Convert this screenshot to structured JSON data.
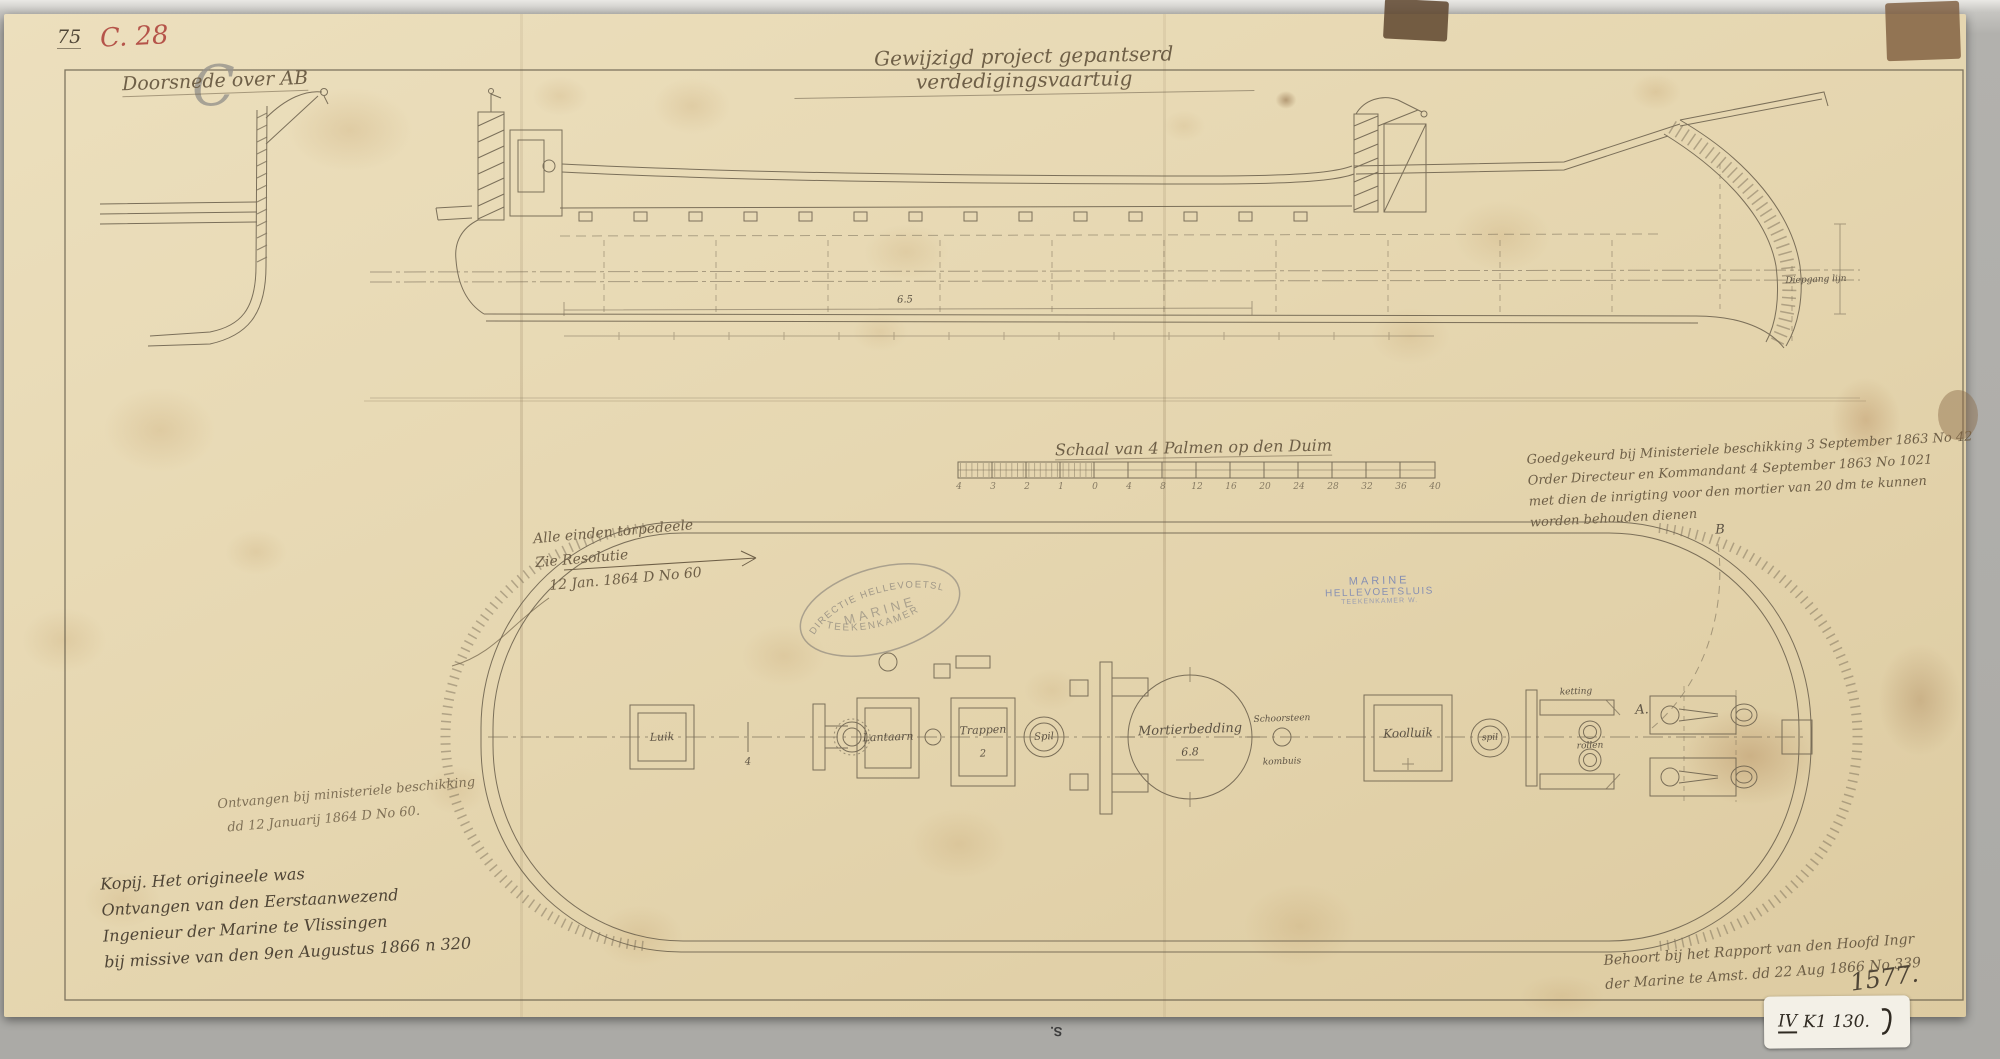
{
  "sheet": {
    "corner_number": "75",
    "corner_letter": "C",
    "corner_code": "C. 28",
    "title": "Gewijzigd project gepantserd verdedigingsvaartuig",
    "section_label": "Doorsnede over AB",
    "edge_mark": "S.",
    "archive_number": "1577.",
    "archive_label_roman": "IV",
    "archive_label_rest": "K1 130."
  },
  "scalebar": {
    "label": "Schaal van 4 Palmen op den Duim",
    "ticks": [
      "4",
      "3",
      "2",
      "1",
      "0",
      "4",
      "8",
      "12",
      "16",
      "20",
      "24",
      "28",
      "32",
      "36",
      "40"
    ]
  },
  "notes": {
    "resolution": [
      "Alle einden torpedeele",
      "Zie Resolutie",
      "12 Jan. 1864 D No 60"
    ],
    "approval": [
      "Goedgekeurd bij Ministeriele beschikking 3 September 1863 No 42",
      "Order Directeur en Kommandant 4 September 1863 No 1021",
      "met dien de inrigting voor den mortier van 20 dm te kunnen",
      "worden behouden dienen"
    ],
    "received": [
      "Ontvangen bij ministeriele beschikking",
      "dd 12 Januarij 1864 D No 60."
    ],
    "copy": [
      "Kopij. Het origineele was",
      "Ontvangen van den Eerstaanwezend",
      "Ingenieur der Marine te Vlissingen",
      "bij missive van den 9en Augustus 1866 n 320"
    ],
    "report": [
      "Behoort bij het Rapport van den Hoofd Ingr",
      "der Marine te Amst. dd 22 Aug 1866 No 339"
    ]
  },
  "stamps": {
    "oval_top": "DIRECTIE HELLEVOETSLUIS",
    "oval_middle": "MARINE",
    "oval_bottom": "TEEKENKAMER",
    "blue_line1": "MARINE",
    "blue_line2": "HELLEVOETSLUIS",
    "blue_line3": "TEEKENKAMER W."
  },
  "plan": {
    "luik": "Luik",
    "tick4": "4",
    "lantaarn": "Lantaarn",
    "trappen": "Trappen",
    "trappen_n": "2",
    "spil1": "Spil",
    "mortier": "Mortierbedding",
    "mortier_dim": "6.8",
    "schoorsteen": "Schoorsteen",
    "kombuis": "kombuis",
    "koolluik": "Koolluik",
    "spil2": "spil",
    "ketting": "ketting",
    "rollen": "rollen",
    "marker_a": "A.",
    "marker_b": "B"
  },
  "elevation": {
    "dim_length": "6.5",
    "waterline_note": "Diepgang lijn"
  },
  "colors": {
    "paper": "#e8d9b3",
    "ink": "#6f6450",
    "red_pencil": "#b5544a",
    "blue_stamp": "#7b87b4"
  }
}
